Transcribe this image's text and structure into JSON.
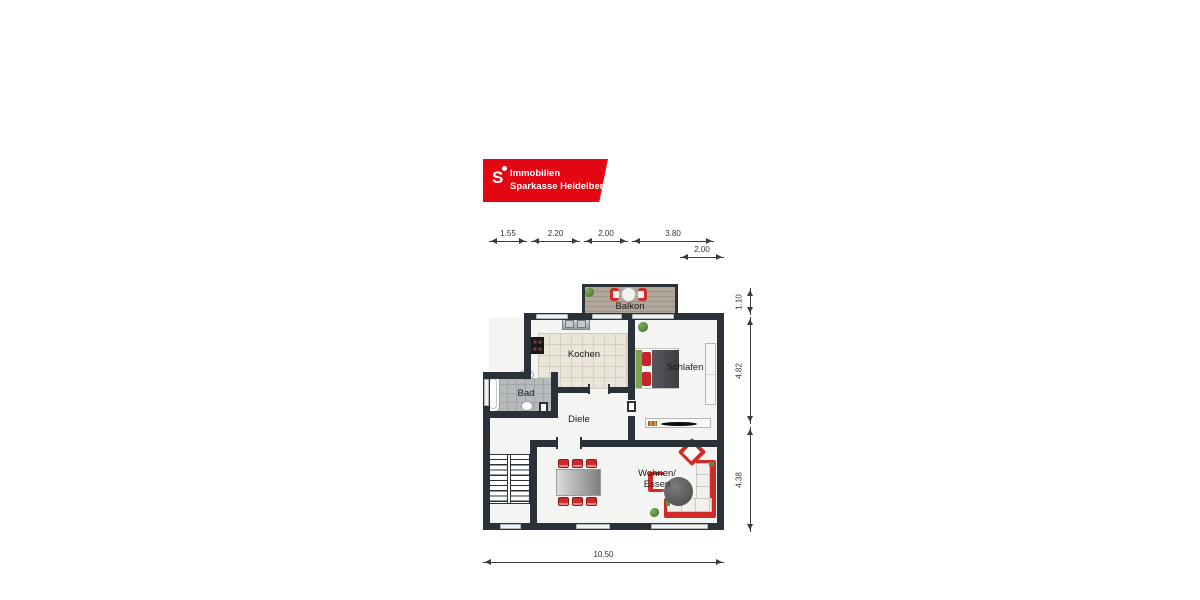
{
  "logo": {
    "icon": "sparkasse-s-icon",
    "line1": "Immobilien",
    "line2": "Sparkasse Heidelberg",
    "brand_red": "#e30613"
  },
  "rooms": {
    "balkon": "Balkon",
    "kochen": "Kochen",
    "schlafen": "Schlafen",
    "bad": "Bad",
    "diele": "Diele",
    "wohnen_line1": "Wohnen/",
    "wohnen_line2": "Essen"
  },
  "dimensions": {
    "top": [
      "1.55",
      "2.20",
      "2.00",
      "3.80"
    ],
    "top_offset": "2.00",
    "right": [
      "1.10",
      "4.82",
      "4.38"
    ],
    "bottom": "10.50"
  },
  "colors": {
    "wall": "#2b3138",
    "furniture_red": "#cf2b28",
    "kitchen_tile": "#eae5da",
    "bath_tile": "#b7babc",
    "balcony_wood": "#a89e93"
  }
}
